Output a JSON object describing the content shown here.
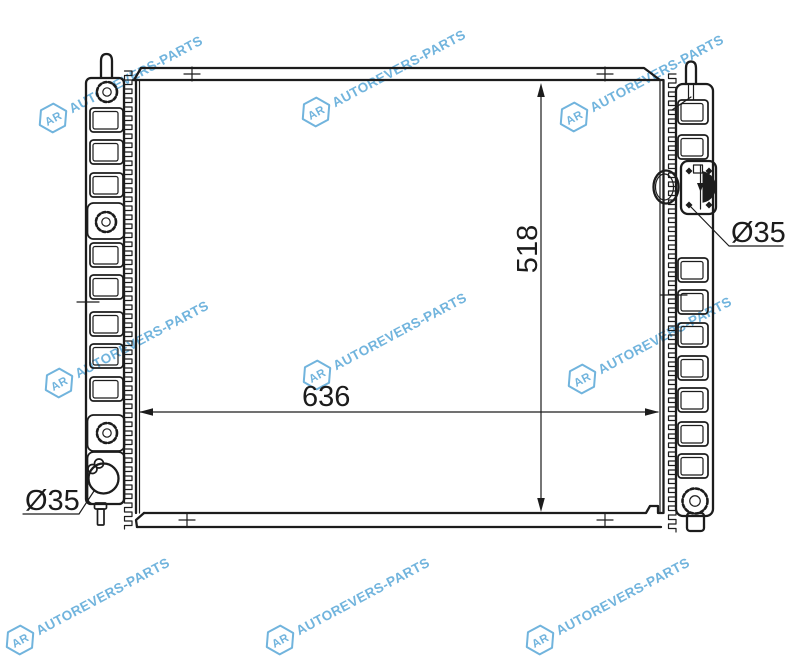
{
  "page": {
    "background_color": "#ffffff"
  },
  "drawing": {
    "subject": "automotive-radiator-technical-drawing",
    "view": "front view with left and right side tanks",
    "line_color": "#1c1c1c",
    "dimensions": {
      "core_width": {
        "value": "636"
      },
      "core_height": {
        "value": "518"
      },
      "left_pipe": {
        "value": "Ø35"
      },
      "right_pipe": {
        "value": "Ø35"
      }
    }
  },
  "watermark": {
    "logo_text": "AR",
    "brand_text": "AUTOREVERS-PARTS",
    "color": "#4a9fd4"
  }
}
